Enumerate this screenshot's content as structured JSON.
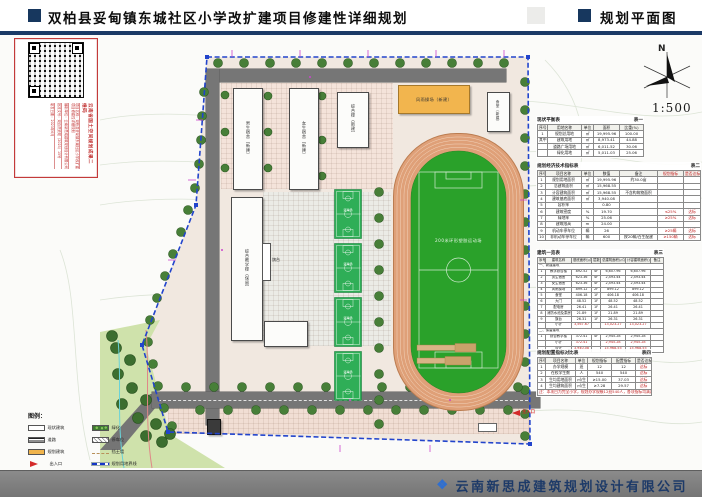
{
  "header": {
    "title": "双柏县妥甸镇东城社区小学改扩建项目修建性详细规划",
    "view_label": "规划平面图"
  },
  "stamp": {
    "heading": "云南省国土空间规划成果二维码",
    "lines": [
      "项目名称：双柏县妥甸镇东城社区小学改扩建项目修建性详细规划",
      "编制单位：云南新思成建筑规划设计有限公司",
      "批准文号：双自然资规〔2023〕15号",
      "制发日期：2023年6月"
    ]
  },
  "compass": {
    "north_label": "N",
    "scale_label": "1:500"
  },
  "plan": {
    "buildings": [
      {
        "label": "男生宿舍（新建）"
      },
      {
        "label": "女生宿舍（新建）"
      },
      {
        "label": "综合楼（新建）"
      },
      {
        "label": "风雨操场（新建）"
      },
      {
        "label": "食堂（新建）"
      },
      {
        "label": "综合教学楼（保留）"
      }
    ],
    "flag_label": "旗台",
    "field_label": "200米环形塑胶运动场",
    "court_label": "篮球场",
    "entrance_label": "主入口"
  },
  "legend": {
    "title": "图例：",
    "items": [
      {
        "label": "现状建筑"
      },
      {
        "label": "道路"
      },
      {
        "label": "规划建筑"
      },
      {
        "label": "出入口"
      },
      {
        "label": "绿化"
      },
      {
        "label": "停车位"
      },
      {
        "label": "挡土墙"
      },
      {
        "label": "规划用地界线"
      }
    ]
  },
  "tables": {
    "t1": {
      "title": "现状平衡表",
      "tag": "表一",
      "columns": [
        "序号",
        "用地名称",
        "单位",
        "面积",
        "比重(%)"
      ],
      "rows": [
        [
          "1",
          "规划总用地",
          "㎡",
          "19,995.96",
          "100.00"
        ],
        [
          "其中",
          "建筑用地",
          "㎡",
          "8,973.41",
          "44.88"
        ],
        [
          "",
          "道路广场用地",
          "㎡",
          "6,011.52",
          "30.06"
        ],
        [
          "",
          "绿化用地",
          "㎡",
          "5,011.03",
          "25.06"
        ]
      ]
    },
    "t2": {
      "title": "规划经济技术指标表",
      "tag": "表二",
      "columns": [
        "序号",
        "项目名称",
        "单位",
        "数值",
        "备注",
        "^规划指标",
        "^是否达标"
      ],
      "rows": [
        [
          "1",
          "规划用地面积",
          "㎡",
          "19,995.96",
          "约30.0亩",
          "",
          ""
        ],
        [
          "2",
          "总建筑面积",
          "㎡",
          "15,968.55",
          "",
          "",
          ""
        ],
        [
          "3",
          "计容建筑面积",
          "㎡",
          "15,968.55",
          "不含构筑物面积",
          "",
          ""
        ],
        [
          "4",
          "建筑基底面积",
          "㎡",
          "3,940.08",
          "",
          "",
          ""
        ],
        [
          "5",
          "容积率",
          "",
          "0.80",
          "",
          "",
          ""
        ],
        [
          "6",
          "建筑密度",
          "%",
          "19.70",
          "",
          "^≤25%",
          "^达标"
        ],
        [
          "7",
          "绿地率",
          "%",
          "25.06",
          "",
          "^≥25%",
          "^达标"
        ],
        [
          "8",
          "建筑限高",
          "m",
          "24.00",
          "",
          "",
          ""
        ],
        [
          "9",
          "机动车停车位",
          "辆",
          "26",
          "",
          "^≥25辆",
          "^达标"
        ],
        [
          "10",
          "非机动车停车位",
          "辆",
          "600",
          "按20辆/百生配建",
          "^≥150辆",
          "^达标"
        ]
      ]
    },
    "t3": {
      "title": "建筑一览表",
      "tag": "表三",
      "columns": [
        "序号",
        "建筑名称",
        "基底面积(㎡)",
        "层数",
        "总建筑面积(㎡)",
        "计容建筑面积(㎡)",
        "备注"
      ],
      "rows": [
        [
          "@7一、新建建筑"
        ],
        [
          "1",
          "教学综合楼",
          "892.52",
          "4F",
          "6,607.96",
          "6,607.96",
          ""
        ],
        [
          "2",
          "男生宿舍",
          "623.36",
          "4F",
          "2,493.44",
          "2,493.44",
          ""
        ],
        [
          "3",
          "女生宿舍",
          "623.36",
          "4F",
          "2,493.44",
          "2,493.44",
          ""
        ],
        [
          "4",
          "风雨操场",
          "899.12",
          "2F",
          "899.12",
          "899.12",
          ""
        ],
        [
          "5",
          "食堂",
          "406.18",
          "1F",
          "406.18",
          "406.18",
          ""
        ],
        [
          "6",
          "大门",
          "48.52",
          "1F",
          "48.52",
          "48.52",
          ""
        ],
        [
          "7",
          "配电房",
          "26.41",
          "1F",
          "26.41",
          "26.41",
          ""
        ],
        [
          "8",
          "消防水池及泵房",
          "21.89",
          "1F",
          "21.89",
          "21.89",
          ""
        ],
        [
          "9",
          "旗台",
          "26.31",
          "1F",
          "26.31",
          "26.31",
          ""
        ],
        [
          "",
          "小计",
          "^3,567.67",
          "",
          "^13,023.27",
          "^13,023.27",
          ""
        ],
        [
          "@7二、保留建筑"
        ],
        [
          "1",
          "综合教学楼",
          "372.41",
          "4F",
          "2,945.28",
          "2,945.28",
          ""
        ],
        [
          "",
          "小计",
          "^372.41",
          "",
          "^2,945.28",
          "^2,945.28",
          ""
        ],
        [
          "",
          "合计",
          "^3,940.08",
          "",
          "^15,968.55",
          "^15,968.55",
          ""
        ]
      ]
    },
    "t4": {
      "title": "规划配置指标对比表",
      "tag": "表四",
      "columns": [
        "序号",
        "项目名称",
        "单位",
        "规划指标",
        "配置指标",
        "是否达标"
      ],
      "rows": [
        [
          "1",
          "办学规模",
          "班",
          "12",
          "12",
          "^达标"
        ],
        [
          "2",
          "在校学生数",
          "人",
          "540",
          "540",
          "^达标"
        ],
        [
          "3",
          "生均用地面积",
          "㎡/生",
          "≥15.00",
          "37.03",
          "^达标"
        ],
        [
          "4",
          "生均建筑面积",
          "㎡/生",
          "≥7.28",
          "29.57",
          "^达标"
        ],
        [
          "@6^注：本项目为完全小学，规划办学规模12班540人，各项指标均满足办学标准要求。"
        ]
      ]
    }
  },
  "footer": {
    "company": "云南新思成建筑规划设计有限公司"
  }
}
